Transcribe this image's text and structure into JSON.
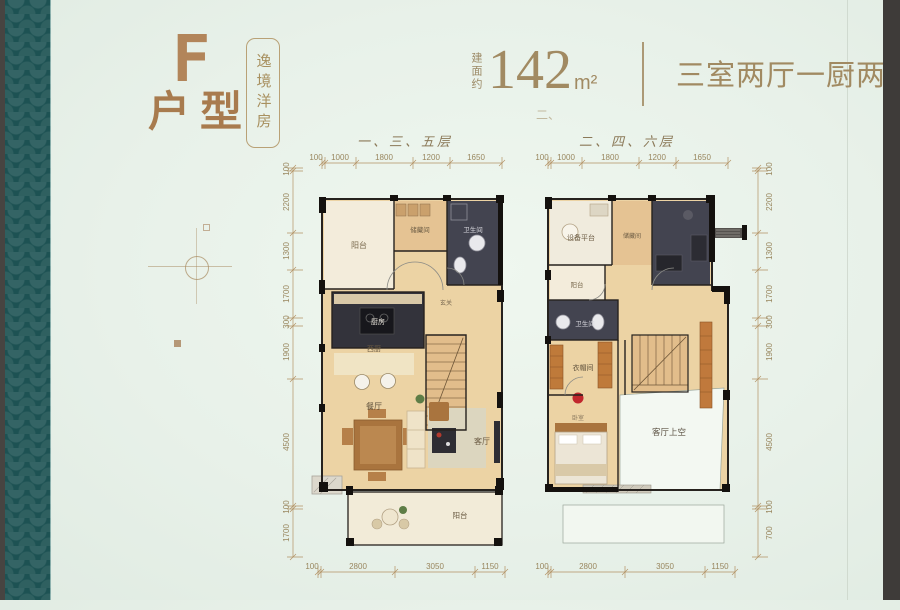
{
  "page": {
    "bg": "#e9f2ea",
    "accent": "#a8815a",
    "teal_band": "#1d5253",
    "side_bar": "#3e3b39",
    "dim_color": "#99875f"
  },
  "header": {
    "logo_letter": "F",
    "unit_label": "户型",
    "tagline": "逸境洋房",
    "area_prefix": "建面约",
    "area_value": "142",
    "area_unit": "m²",
    "rooms_summary": "三室两厅一厨两卫",
    "stray_mark": "二、"
  },
  "plan_left": {
    "title": "一、三、五层",
    "dims_top": [
      "100",
      "1000",
      "1800",
      "1200",
      "1650"
    ],
    "dims_side": [
      "100",
      "2200",
      "1300",
      "1700",
      "300",
      "1900",
      "4500",
      "100",
      "1700"
    ],
    "dims_bottom": [
      "100",
      "2800",
      "3050",
      "1150"
    ],
    "rooms": {
      "balcony_top": "阳台",
      "storage": "储藏间",
      "bath": "卫生间",
      "kitchen": "厨房",
      "west_kitchen": "西厨",
      "foyer": "玄关",
      "dining": "餐厅",
      "living": "客厅",
      "balcony_bottom": "阳台"
    }
  },
  "plan_right": {
    "title": "二、四、六层",
    "dims_top": [
      "100",
      "1000",
      "1800",
      "1200",
      "1650"
    ],
    "dims_side": [
      "100",
      "2200",
      "1300",
      "1700",
      "300",
      "1900",
      "4500",
      "100",
      "700"
    ],
    "dims_bottom": [
      "100",
      "2800",
      "3050",
      "1150"
    ],
    "rooms": {
      "equipment": "设备平台",
      "storage": "储藏间",
      "balcony": "阳台",
      "bath": "卫生间",
      "cloak": "衣帽间",
      "bedroom": "卧室",
      "living_void": "客厅上空"
    }
  }
}
